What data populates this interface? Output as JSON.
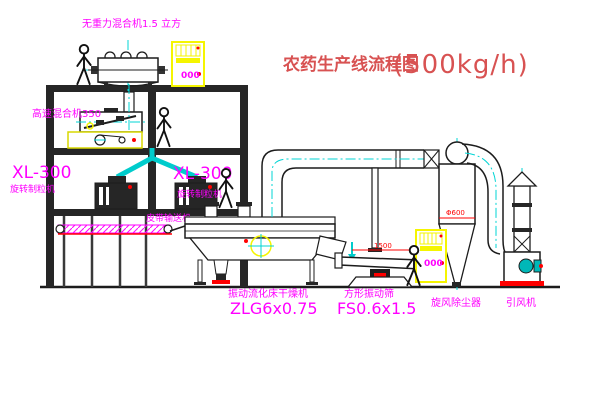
{
  "title": {
    "main": "农药生产线流程图",
    "capacity": "(500kg/h)"
  },
  "labels": {
    "gravity_mixer": "无重力混合机1.5 立方",
    "high_speed_mixer": "高速混合机350",
    "xl300_left": {
      "model": "XL-300",
      "name": "旋转制粒机"
    },
    "xl300_mid": {
      "model": "XL-300",
      "name": "旋转制粒机"
    },
    "belt_conveyor": "皮带输送机",
    "dryer": {
      "name": "振动流化床干燥机",
      "model": "ZLG6x0.75"
    },
    "screen": {
      "name": "方形振动筛",
      "model": "FS0.6x1.5"
    },
    "cyclone": "旋风除尘器",
    "fan": "引风机"
  },
  "dims": {
    "screen_length": "1500",
    "screen_height": "350",
    "cyclone_diameter": "Φ600"
  },
  "cabinets": {
    "display": "000"
  },
  "colors": {
    "label_magenta": "#ff00ff",
    "title_red": "#d85252",
    "dimension_red": "#ff0000",
    "centerline_cyan": "#00d4d4",
    "chute_cyan": "#00cccc",
    "equipment_yellow": "#f5f500",
    "motor_teal": "#00b8b8",
    "line_black": "#1c1c1c",
    "structure_dark": "#262626"
  }
}
